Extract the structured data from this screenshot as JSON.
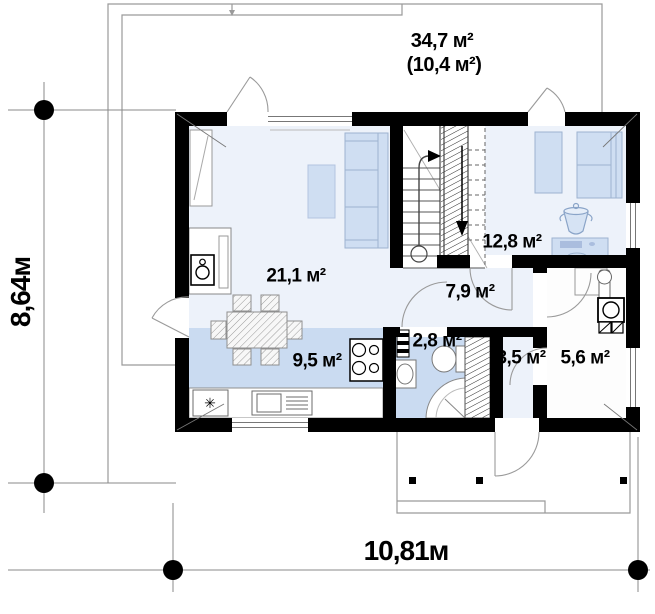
{
  "title": "floor-plan-first-floor",
  "labels": {
    "attic_area": "34,7 м²",
    "attic_area_secondary": "(10,4 м²)",
    "living_room": "21,1 м²",
    "kitchen": "9,5 м²",
    "hall": "7,9 м²",
    "bedroom": "12,8 м²",
    "bathroom": "2,8 м²",
    "vestibule": "3,5 м²",
    "utility": "5,6 м²"
  },
  "dimensions": {
    "height_label": "8,64м",
    "width_label": "10,81м"
  },
  "icons": {
    "fridge_symbol": "✳"
  },
  "colors": {
    "wall": "#000000",
    "floor_light": "#edf2fa",
    "floor_blue": "#cadbf1",
    "furniture_fill": "#cfdef2",
    "furniture_border": "#9db3d0",
    "thin_line": "#8a8a8a"
  }
}
